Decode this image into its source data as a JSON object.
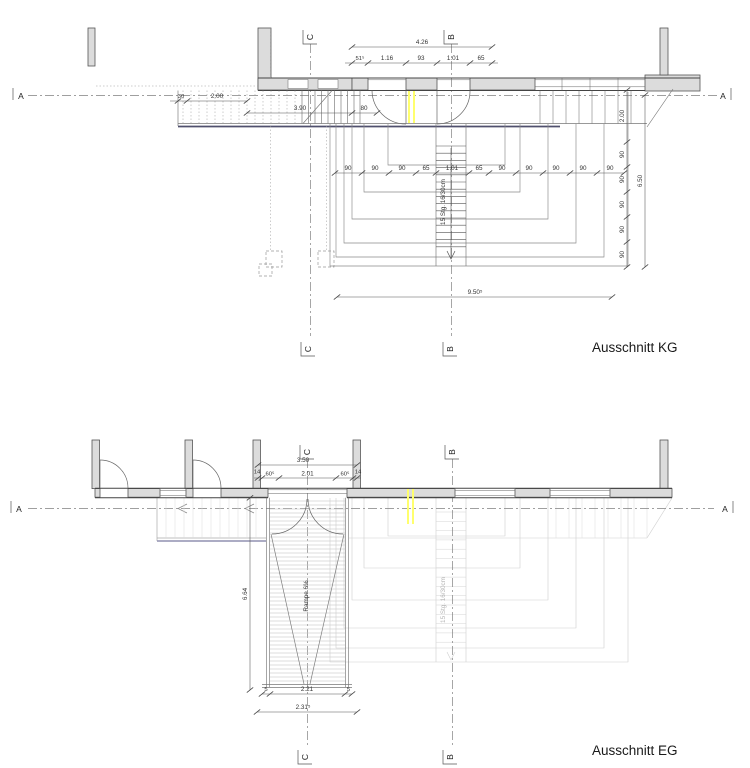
{
  "colors": {
    "background": "#ffffff",
    "wall_fill": "#dcdcdc",
    "line": "#555555",
    "faint_overlay": "#cfcfcf",
    "axis_line": "#808080",
    "highlight": "#ffff6e",
    "slab_accent": "#50506e"
  },
  "kg": {
    "title": "Ausschnitt KG",
    "axes": {
      "a_left": "A",
      "a_right": "A",
      "b_top": "B",
      "b_bottom": "B",
      "c_top": "C",
      "c_bottom": "C"
    },
    "stair_note": "15 Stg. 16/30cm",
    "dims": {
      "overall_top": "4.26",
      "top_chain": [
        "51⁵",
        "1.16",
        "93",
        "1.01",
        "65"
      ],
      "left_a": "30",
      "left_b": "2.00",
      "left_c": "3.90",
      "left_d": "80",
      "mid_chain": [
        "90",
        "90",
        "90",
        "65",
        "1.01",
        "65",
        "90",
        "90",
        "90",
        "90",
        "90"
      ],
      "right_top": "2.00",
      "right_chain": [
        "90",
        "90",
        "90",
        "90",
        "90"
      ],
      "right_overall": "6.50",
      "bottom_overall": "9.50⁵"
    }
  },
  "eg": {
    "title": "Ausschnitt EG",
    "axes": {
      "a_left": "A",
      "a_right": "A",
      "b_top": "B",
      "b_bottom": "B",
      "c_top": "C",
      "c_bottom": "C"
    },
    "ramp_note": "Rampe 6%",
    "stair_note_faint": "15 Stg. 16/30cm",
    "dims": {
      "overall_top": "3.50",
      "top_chain": [
        "14",
        "60⁵",
        "2.01",
        "60⁵",
        "14"
      ],
      "left_overall": "6.64",
      "bottom_chain": [
        "5",
        "2.21",
        "5"
      ],
      "bottom_overall": "2.31⁵"
    }
  }
}
